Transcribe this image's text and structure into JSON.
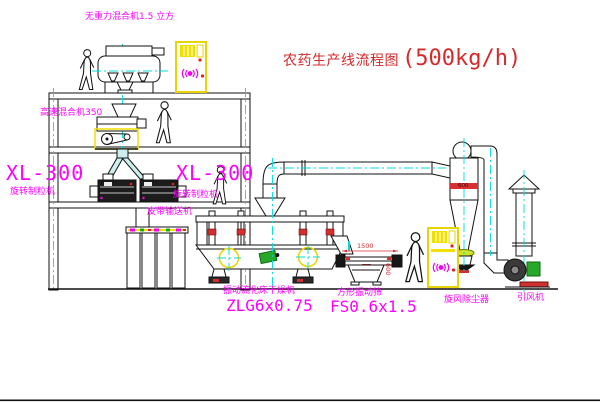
{
  "title": {
    "main": "农药生产线流程图",
    "capacity": "(500kg/h)"
  },
  "equipment_labels": {
    "zero_gravity_mixer": "无重力混合机1.5 立方",
    "high_speed_mixer": "高速混合机350",
    "granulator_left": {
      "model": "XL-300",
      "name": "旋转制粒机"
    },
    "granulator_right": {
      "model": "XL-300",
      "name": "旋转制粒机"
    },
    "belt_conveyor": "皮带输送机",
    "fluid_bed_dryer": {
      "name": "振动流化床干燥机",
      "model": "ZLG6x0.75"
    },
    "vibrating_sieve": {
      "name": "方形振动筛",
      "model": "FS0.6x1.5"
    },
    "cyclone_dust_collector": "旋风除尘器",
    "induced_draft_fan": "引风机"
  },
  "dimensions": {
    "sieve_length": "1500",
    "sieve_width": "600",
    "cyclone_band": "600"
  },
  "colors": {
    "label_magenta": "#ff00ff",
    "title_red": "#d42a2a",
    "centerline_cyan": "#00dcdc",
    "cabinet_yellow": "#f0e000",
    "line_black": "#111111",
    "motor_green": "#28a828",
    "accent_red": "#d03030"
  }
}
